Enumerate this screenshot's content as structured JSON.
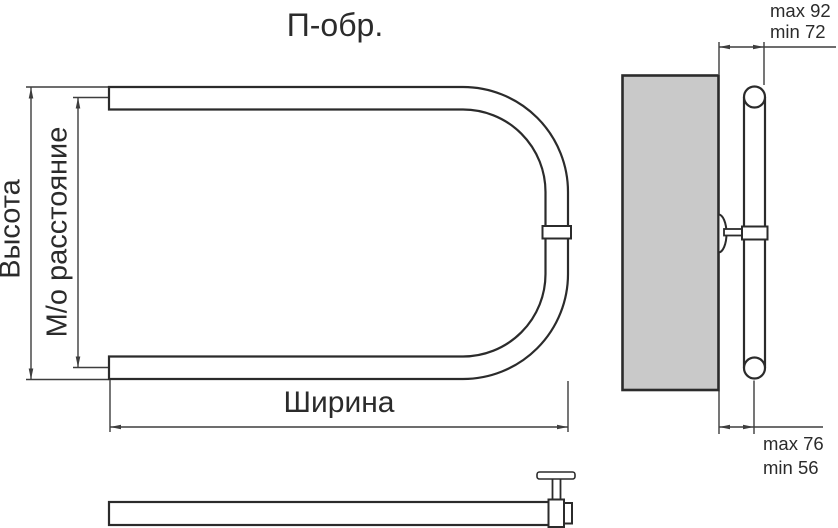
{
  "title": "П-обр.",
  "front_view": {
    "height_label": "Высота",
    "center_distance_label": "М/о расстояние",
    "width_label": "Ширина"
  },
  "side_view": {
    "wall_offset_top": {
      "max": "max 92",
      "min": "min 72"
    },
    "wall_offset_bottom": {
      "max": "max 76",
      "min": "min 56"
    }
  },
  "colors": {
    "object_line": "#2b2b2b",
    "dimension_line": "#3d3d3d",
    "wall_fill": "#c9c9c9",
    "background": "#ffffff"
  }
}
